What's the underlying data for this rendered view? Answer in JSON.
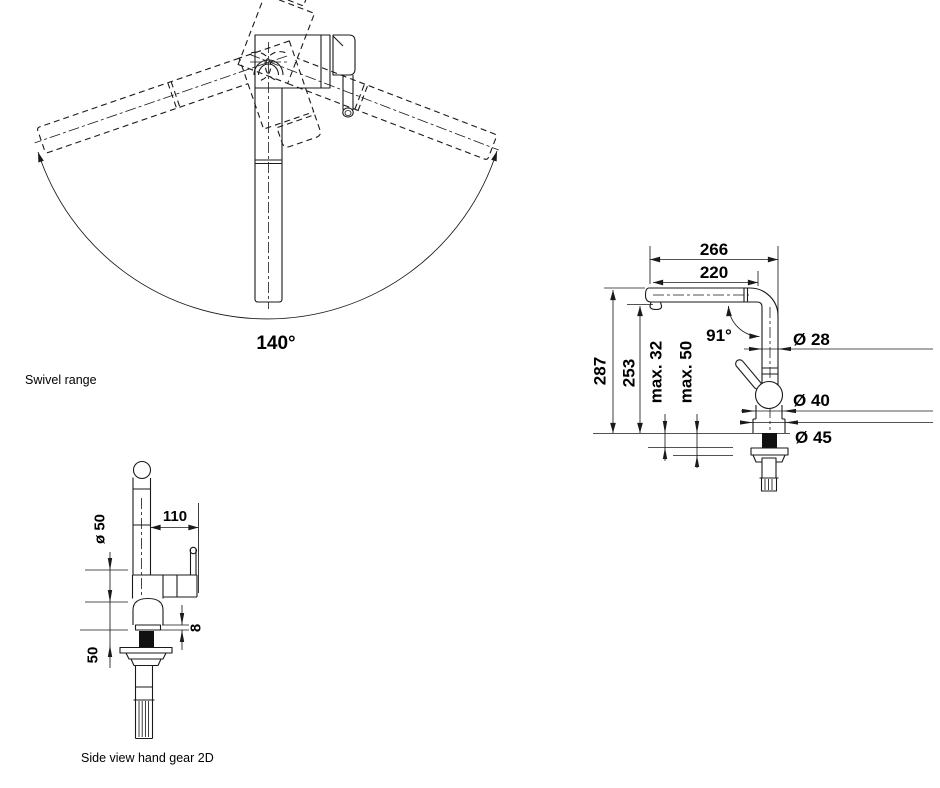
{
  "drawing": {
    "swivel_view": {
      "caption": "Swivel range",
      "swivel_angle": "140°"
    },
    "side_view": {
      "projection_width": "266",
      "spout_reach": "220",
      "height_total": "287",
      "spout_height": "253",
      "max_counter_thickness_1": "max. 32",
      "max_counter_thickness_2": "max. 50",
      "spout_angle": "91°",
      "spout_diameter": "Ø 28",
      "body_diameter": "Ø 40",
      "base_diameter": "Ø 45"
    },
    "hand_gear_view": {
      "caption": "Side view hand gear 2D",
      "base_diameter": "ø 50",
      "lever_reach": "110",
      "base_height": "8",
      "lever_height": "50"
    }
  },
  "colors": {
    "background": "#ffffff",
    "line": "#1a1a1a",
    "text": "#000000"
  }
}
